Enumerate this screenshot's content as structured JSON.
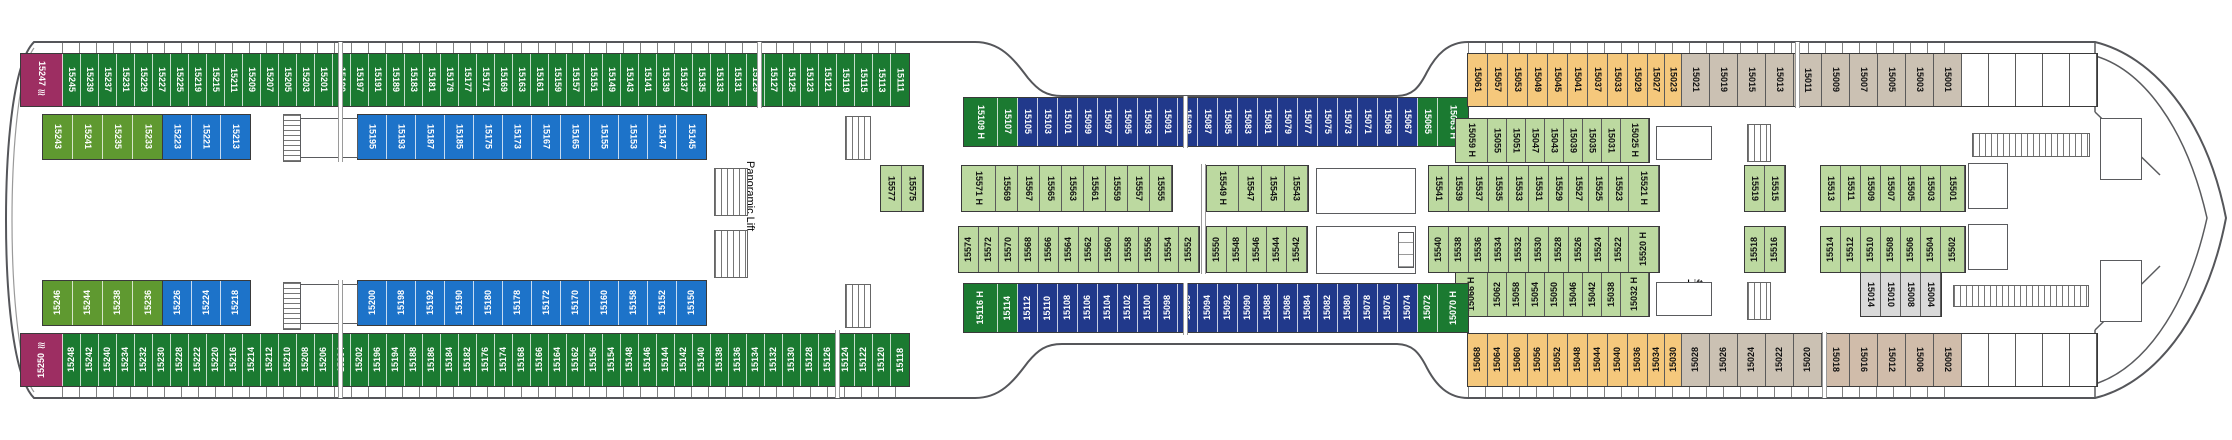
{
  "deck_plan": {
    "labels": [
      {
        "text": "Panoramic Lift",
        "x": 742,
        "y": 126,
        "w": 16,
        "h": 140,
        "vertical": true,
        "name": "panoramic-lift-label"
      },
      {
        "text": "Lift",
        "x": 1660,
        "y": 138,
        "w": 70,
        "h": 16,
        "vertical": false,
        "name": "lift-label"
      },
      {
        "text": "Lift",
        "x": 1660,
        "y": 276,
        "w": 70,
        "h": 16,
        "vertical": false,
        "name": "lift-label"
      }
    ],
    "icons": {
      "wave": "≋"
    },
    "colors": {
      "og": "#1b7a31",
      "mg": "#5f9930",
      "mr": "#9d2e62",
      "bl": "#1d73c9",
      "nv": "#21398b",
      "pg": "#bcd9a0",
      "or": "#f5c87c",
      "tp": "#cbc1b3",
      "t2": "#d0bcaa",
      "gy": "#d9d9d9",
      "mt": "#ffffff"
    },
    "rows": [
      {
        "id": "top-outer-left",
        "x": 20,
        "y": 53,
        "h": 54,
        "cw": 18,
        "dir": "down",
        "color": "og",
        "cells": [
          {
            "n": "15247",
            "c": "mr",
            "w": 42,
            "icon": "wave"
          },
          "15245",
          "15239",
          "15237",
          "15231",
          "15229",
          "15227",
          "15225",
          "15219",
          "15215",
          "15211",
          "15209",
          "15207",
          "15205",
          "15203",
          "15201",
          "15199",
          "15197",
          "15191",
          "15189",
          "15183",
          "15181",
          "15179",
          "15177",
          "15171",
          "15169",
          "15163",
          "15161",
          "15159",
          "15157",
          "15151",
          "15149",
          "15143",
          "15141",
          "15139",
          "15137",
          "15135",
          "15133",
          "15131",
          "15129",
          "15127",
          "15125",
          "15123",
          "15121",
          "15119",
          "15115",
          "15113",
          "15111"
        ]
      },
      {
        "id": "top-inner-left-green",
        "x": 42,
        "y": 114,
        "h": 46,
        "cw": 30,
        "dir": "down",
        "color": "mg",
        "cells": [
          "15243",
          "15241",
          "15235",
          "15233"
        ]
      },
      {
        "id": "top-inner-left-blue-a",
        "x": 162,
        "y": 114,
        "h": 46,
        "cw": 29,
        "dir": "down",
        "color": "bl",
        "cells": [
          "15223",
          "15221",
          "15213"
        ]
      },
      {
        "id": "top-inner-left-blue-b",
        "x": 357,
        "y": 114,
        "h": 46,
        "cw": 29,
        "dir": "down",
        "color": "bl",
        "cells": [
          "15195",
          "15193",
          "15187",
          "15185",
          "15175",
          "15173",
          "15167",
          "15165",
          "15155",
          "15153",
          "15147",
          "15145"
        ]
      },
      {
        "id": "top-navy",
        "x": 963,
        "y": 97,
        "h": 50,
        "cw": 20,
        "dir": "down",
        "color": "nv",
        "cells": [
          {
            "n": "15109 H",
            "c": "og",
            "w": 34
          },
          {
            "n": "15107",
            "c": "og"
          },
          "15105",
          "15103",
          "15101",
          "15099",
          "15097",
          "15095",
          "15093",
          "15091",
          "15089",
          "15087",
          "15085",
          "15083",
          "15081",
          "15079",
          "15077",
          "15075",
          "15073",
          "15071",
          "15069",
          "15067",
          {
            "n": "15065",
            "c": "og"
          },
          {
            "n": "15063 H",
            "c": "og",
            "w": 30
          }
        ]
      },
      {
        "id": "top-orange",
        "x": 1467,
        "y": 53,
        "h": 54,
        "cw": 20,
        "dir": "down",
        "color": "or",
        "cells": [
          "15061",
          "15057",
          "15053",
          "15049",
          "15045",
          "15041",
          "15037",
          "15033",
          "15029",
          {
            "n": "15027",
            "w": 17
          },
          {
            "n": "15023",
            "w": 17
          },
          {
            "n": "15021",
            "c": "tp",
            "w": 28
          },
          {
            "n": "15019",
            "c": "tp",
            "w": 28
          },
          {
            "n": "15015",
            "c": "tp",
            "w": 28
          },
          {
            "n": "15013",
            "c": "tp",
            "w": 28
          },
          {
            "n": "15011",
            "c": "tp",
            "w": 28
          },
          {
            "n": "15009",
            "c": "tp",
            "w": 28
          },
          {
            "n": "15007",
            "c": "tp",
            "w": 28
          },
          {
            "n": "15005",
            "c": "tp",
            "w": 28
          },
          {
            "n": "15003",
            "c": "tp",
            "w": 28
          },
          {
            "n": "15001",
            "c": "tp",
            "w": 28
          },
          {
            "n": "",
            "c": "mt",
            "w": 27
          },
          {
            "n": "",
            "c": "mt",
            "w": 27
          },
          {
            "n": "",
            "c": "mt",
            "w": 27
          },
          {
            "n": "",
            "c": "mt",
            "w": 27
          },
          {
            "n": "",
            "c": "mt",
            "w": 27
          }
        ]
      },
      {
        "id": "mid-upper-a",
        "x": 880,
        "y": 165,
        "h": 47,
        "cw": 21,
        "dir": "down",
        "color": "pg",
        "cells": [
          "15577",
          "15575"
        ]
      },
      {
        "id": "mid-upper-b",
        "x": 961,
        "y": 165,
        "h": 47,
        "cw": 22,
        "dir": "down",
        "color": "pg",
        "cells": [
          {
            "n": "15571 H",
            "w": 34
          },
          "15569",
          "15567",
          "15565",
          "15563",
          "15561",
          "15559",
          "15557",
          "15555"
        ]
      },
      {
        "id": "mid-upper-c",
        "x": 1206,
        "y": 165,
        "h": 47,
        "cw": 23,
        "dir": "down",
        "color": "pg",
        "cells": [
          {
            "n": "15549 H",
            "w": 32
          },
          "15547",
          "15545",
          "15543"
        ]
      },
      {
        "id": "mid-upper-d",
        "x": 1428,
        "y": 165,
        "h": 47,
        "cw": 20,
        "dir": "down",
        "color": "pg",
        "cells": [
          "15541",
          "15539",
          "15537",
          "15535",
          "15533",
          "15531",
          "15529",
          "15527",
          "15525",
          "15523",
          {
            "n": "15521 H",
            "w": 30
          }
        ]
      },
      {
        "id": "mid-upper-e",
        "x": 1744,
        "y": 165,
        "h": 47,
        "cw": 20,
        "dir": "down",
        "color": "pg",
        "cells": [
          "15519",
          "15515"
        ]
      },
      {
        "id": "mid-upper-f",
        "x": 1820,
        "y": 165,
        "h": 47,
        "cw": 20,
        "dir": "down",
        "color": "pg",
        "cells": [
          "15513",
          "15511",
          "15509",
          "15507",
          "15505",
          "15503",
          {
            "n": "15501",
            "w": 24
          }
        ]
      },
      {
        "id": "right-pale-top",
        "x": 1455,
        "y": 118,
        "h": 45,
        "cw": 19,
        "dir": "down",
        "color": "pg",
        "cells": [
          {
            "n": "15059 H",
            "w": 32
          },
          "15055",
          "15051",
          "15047",
          "15043",
          "15039",
          "15035",
          "15031",
          {
            "n": "15025 H",
            "w": 28
          }
        ]
      },
      {
        "id": "mid-lower-a",
        "x": 958,
        "y": 226,
        "h": 47,
        "cw": 20,
        "dir": "up",
        "color": "pg",
        "cells": [
          "15574",
          "15572",
          "15570",
          "15568",
          "15566",
          "15564",
          "15562",
          "15560",
          "15558",
          "15556",
          "15554",
          "15552"
        ]
      },
      {
        "id": "mid-lower-b",
        "x": 1206,
        "y": 226,
        "h": 47,
        "cw": 20,
        "dir": "up",
        "color": "pg",
        "cells": [
          "15550",
          "15548",
          "15546",
          "15544",
          "15542"
        ]
      },
      {
        "id": "mid-lower-c",
        "x": 1428,
        "y": 226,
        "h": 47,
        "cw": 20,
        "dir": "up",
        "color": "pg",
        "cells": [
          "15540",
          "15538",
          "15536",
          "15534",
          "15532",
          "15530",
          "15528",
          "15526",
          "15524",
          "15522",
          {
            "n": "15520 H",
            "w": 30
          }
        ]
      },
      {
        "id": "mid-lower-d",
        "x": 1744,
        "y": 226,
        "h": 47,
        "cw": 20,
        "dir": "up",
        "color": "pg",
        "cells": [
          "15518",
          "15516"
        ]
      },
      {
        "id": "mid-lower-e",
        "x": 1820,
        "y": 226,
        "h": 47,
        "cw": 20,
        "dir": "up",
        "color": "pg",
        "cells": [
          "15514",
          "15512",
          "15510",
          "15508",
          "15506",
          "15504",
          {
            "n": "15502",
            "w": 24
          }
        ]
      },
      {
        "id": "right-pale-bottom",
        "x": 1455,
        "y": 272,
        "h": 45,
        "cw": 19,
        "dir": "up",
        "color": "pg",
        "cells": [
          {
            "n": "15066 H",
            "w": 32
          },
          "15062",
          "15058",
          "15054",
          "15050",
          "15046",
          "15042",
          "15038",
          {
            "n": "15032 H",
            "w": 28
          }
        ]
      },
      {
        "id": "grey-mid-bottom",
        "x": 1860,
        "y": 272,
        "h": 45,
        "cw": 20,
        "dir": "down",
        "color": "gy",
        "cells": [
          "15014",
          "15010",
          "15008",
          "15004"
        ]
      },
      {
        "id": "bottom-navy",
        "x": 963,
        "y": 283,
        "h": 50,
        "cw": 20,
        "dir": "up",
        "color": "nv",
        "cells": [
          {
            "n": "15116 H",
            "c": "og",
            "w": 34
          },
          {
            "n": "15114",
            "c": "og"
          },
          "15112",
          "15110",
          "15108",
          "15106",
          "15104",
          "15102",
          "15100",
          "15098",
          "15096",
          "15094",
          "15092",
          "15090",
          "15088",
          "15086",
          "15084",
          "15082",
          "15080",
          "15078",
          "15076",
          "15074",
          {
            "n": "15072",
            "c": "og"
          },
          {
            "n": "15070 H",
            "c": "og",
            "w": 30
          }
        ]
      },
      {
        "id": "bottom-inner-left-green",
        "x": 42,
        "y": 280,
        "h": 46,
        "cw": 30,
        "dir": "up",
        "color": "mg",
        "cells": [
          "15246",
          "15244",
          "15238",
          "15236"
        ]
      },
      {
        "id": "bottom-inner-left-blue-a",
        "x": 162,
        "y": 280,
        "h": 46,
        "cw": 29,
        "dir": "up",
        "color": "bl",
        "cells": [
          "15226",
          "15224",
          "15218"
        ]
      },
      {
        "id": "bottom-inner-left-blue-b",
        "x": 357,
        "y": 280,
        "h": 46,
        "cw": 29,
        "dir": "up",
        "color": "bl",
        "cells": [
          "15200",
          "15198",
          "15192",
          "15190",
          "15180",
          "15178",
          "15172",
          "15170",
          "15160",
          "15158",
          "15152",
          "15150"
        ]
      },
      {
        "id": "bottom-outer-left",
        "x": 20,
        "y": 333,
        "h": 54,
        "cw": 18,
        "dir": "up",
        "color": "og",
        "cells": [
          {
            "n": "15250",
            "c": "mr",
            "w": 42,
            "icon": "wave"
          },
          "15248",
          "15242",
          "15240",
          "15234",
          "15232",
          "15230",
          "15228",
          "15222",
          "15220",
          "15216",
          "15214",
          "15212",
          "15210",
          "15208",
          "15206",
          "15204",
          "15202",
          "15196",
          "15194",
          "15188",
          "15186",
          "15184",
          "15182",
          "15176",
          "15174",
          "15168",
          "15166",
          "15164",
          "15162",
          "15156",
          "15154",
          "15148",
          "15146",
          "15144",
          "15142",
          "15140",
          "15138",
          "15136",
          "15134",
          "15132",
          "15130",
          "15128",
          "15126",
          "15124",
          "15122",
          "15120",
          "15118"
        ]
      },
      {
        "id": "bottom-orange",
        "x": 1467,
        "y": 333,
        "h": 54,
        "cw": 20,
        "dir": "up",
        "color": "or",
        "cells": [
          "15068",
          "15064",
          "15060",
          "15056",
          "15052",
          "15048",
          "15044",
          "15040",
          "15036",
          {
            "n": "15034",
            "w": 17
          },
          {
            "n": "15030",
            "w": 17
          },
          {
            "n": "15028",
            "c": "tp",
            "w": 28
          },
          {
            "n": "15026",
            "c": "tp",
            "w": 28
          },
          {
            "n": "15024",
            "c": "tp",
            "w": 28
          },
          {
            "n": "15022",
            "c": "tp",
            "w": 28
          },
          {
            "n": "15020",
            "c": "tp",
            "w": 28
          },
          {
            "n": "15018",
            "c": "t2",
            "w": 28,
            "d": "down"
          },
          {
            "n": "15016",
            "c": "t2",
            "w": 28,
            "d": "down"
          },
          {
            "n": "15012",
            "c": "t2",
            "w": 28,
            "d": "down"
          },
          {
            "n": "15006",
            "c": "t2",
            "w": 28,
            "d": "down"
          },
          {
            "n": "15002",
            "c": "t2",
            "w": 28,
            "d": "down"
          },
          {
            "n": "",
            "c": "mt",
            "w": 27
          },
          {
            "n": "",
            "c": "mt",
            "w": 27
          },
          {
            "n": "",
            "c": "mt",
            "w": 27
          },
          {
            "n": "",
            "c": "mt",
            "w": 27
          },
          {
            "n": "",
            "c": "mt",
            "w": 27
          }
        ]
      }
    ]
  }
}
